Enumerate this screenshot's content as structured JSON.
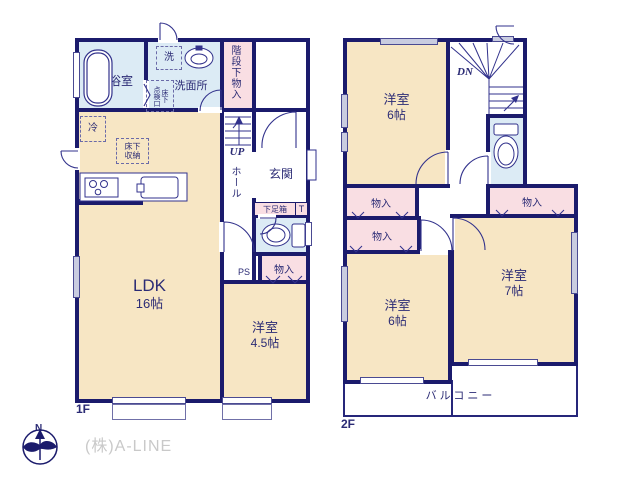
{
  "colors": {
    "wall_navy": "#1b1b6c",
    "line_navy": "#32328c",
    "room_cream": "#f7e6c4",
    "room_blue": "#dcebf5",
    "room_pink": "#f9dee3",
    "window_gray": "#c9cce0",
    "logo_gray": "#c9c9c9"
  },
  "floor1": {
    "label": "1F",
    "bath": "浴室",
    "washroom": "洗面所",
    "laundry": "洗",
    "underfloor_access": "床下\n点検口",
    "stair_storage": "階段下物入",
    "up": "UP",
    "hall": "ホール",
    "entrance": "玄関",
    "shoe_box": "下足箱",
    "toilet_mark": "T",
    "closet": "物入",
    "ps": "PS",
    "fridge": "冷",
    "underfloor_storage": "床下\n収納",
    "ldk": "LDK",
    "ldk_size": "16帖",
    "western_room": "洋室",
    "western_room_size": "4.5帖"
  },
  "floor2": {
    "label": "2F",
    "down": "DN",
    "room_top": "洋室",
    "room_top_size": "6帖",
    "closet_left_upper": "物入",
    "closet_left_lower": "物入",
    "closet_right": "物入",
    "room_bottom_left": "洋室",
    "room_bottom_left_size": "6帖",
    "room_bottom_right": "洋室",
    "room_bottom_right_size": "7帖",
    "balcony": "バルコニー"
  },
  "footer": {
    "company": "(株)A-LINE",
    "north": "N"
  }
}
